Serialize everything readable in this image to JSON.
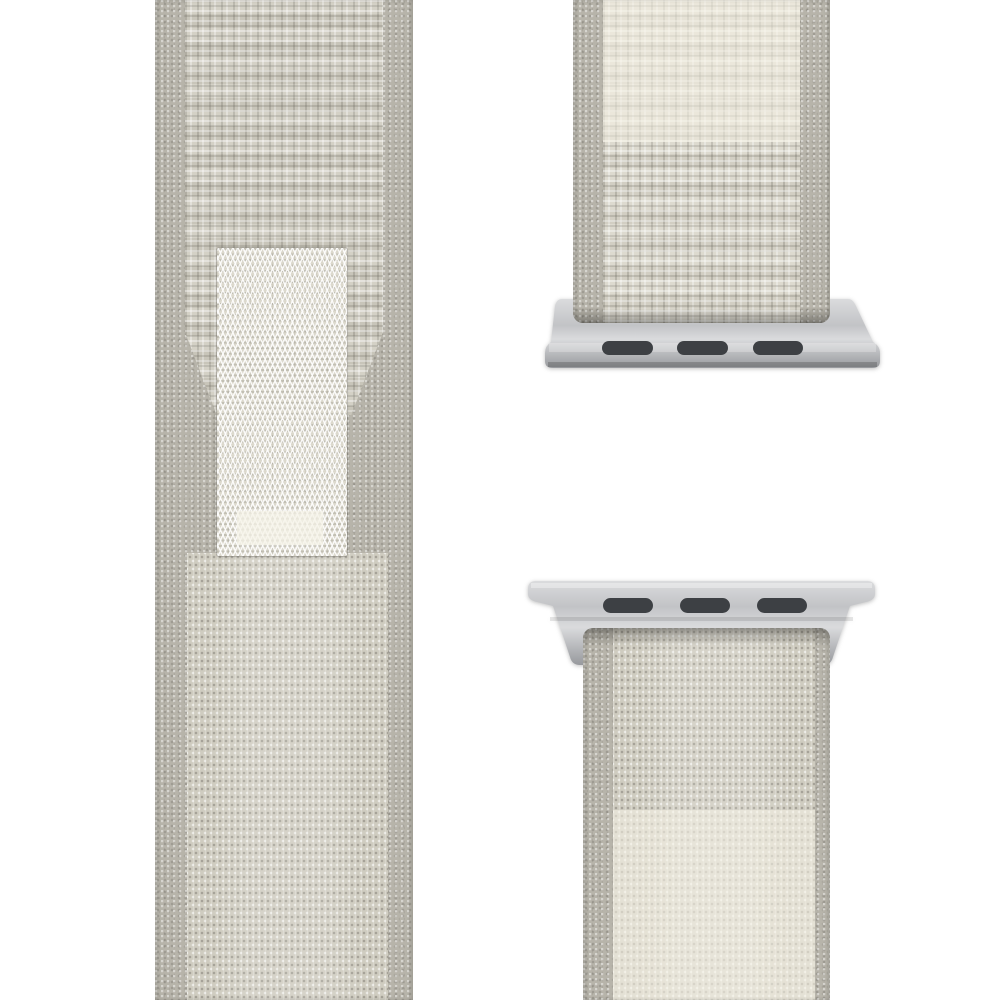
{
  "image": {
    "description": "Product photo of a starlight beige woven nylon sport-loop watch band on a white background: the full strap back with fuzzy loop fabric and a lighter hook fastener tab on the left, and two band ends fitted with silver lug adapters on the right.",
    "background": "#ffffff"
  },
  "colors": {
    "bg": "#ffffff",
    "fuzz": "#b7b4aa",
    "weave-base": "#cfccc0",
    "weave-cream": "#d9d6ca",
    "tab-base": "#dcd9cd",
    "metal-1": "#dadbdd",
    "metal-2": "#c2c3c6",
    "metal-3": "#97999d",
    "slot": "#3d4044"
  },
  "left_strap": {
    "label": "Full strap, back side with fuzzy loop fabric and hook fastener tab",
    "tab_label": "Hook fastener tab with zigzag weave"
  },
  "right_straps": {
    "top_piece_label": "Upper band end with silver lug adapter",
    "bottom_piece_label": "Lower band end with silver lug adapter",
    "adapter_label": "Silver lug adapter",
    "slots_per_adapter": 3
  }
}
